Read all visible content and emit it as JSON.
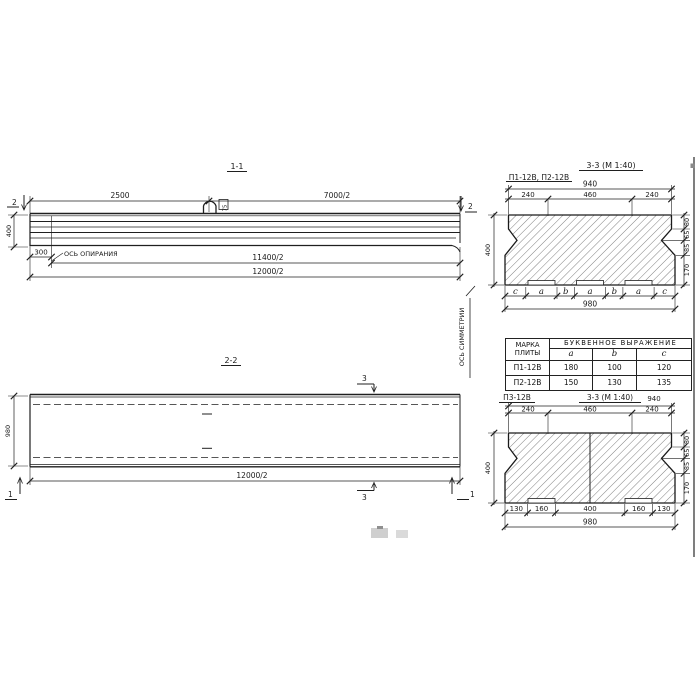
{
  "section11": {
    "title": "1-1",
    "dims": {
      "top_left": "2500",
      "top_right": "7000/2",
      "height": "400",
      "support_offset": "300",
      "to_axis": "11400/2",
      "total": "12000/2"
    },
    "support_axis_label": "ОСЬ ОПИРАНИЯ",
    "loop_label": "75",
    "cut_mark_left": "2",
    "cut_mark_right": "2"
  },
  "section22": {
    "title": "2-2",
    "dims": {
      "width": "980",
      "total": "12000/2"
    },
    "symmetry_axis_label": "ОСЬ СИММЕТРИИ",
    "cut_mark_3_top": "3",
    "cut_mark_3_bottom": "3",
    "cut_mark_1_left": "1",
    "cut_mark_1_right": "1"
  },
  "section33_top": {
    "subtitle": "П1-12В, П2-12В",
    "title": "3-3 (М 1:40)",
    "dims": {
      "top_total": "940",
      "top_left": "240",
      "top_mid": "460",
      "top_right": "240",
      "bottom_total": "980",
      "height": "400"
    },
    "right_dims": [
      "80",
      "65",
      "85",
      "170"
    ],
    "letters": [
      "c",
      "a",
      "b",
      "a",
      "b",
      "a",
      "c"
    ]
  },
  "table": {
    "col1_line1": "МАРКА",
    "col1_line2": "ПЛИТЫ",
    "group_header": "БУКВЕННОЕ ВЫРАЖЕНИЕ",
    "cols": [
      "a",
      "b",
      "c"
    ],
    "rows": [
      {
        "mark": "П1-12В",
        "a": "180",
        "b": "100",
        "c": "120"
      },
      {
        "mark": "П2-12В",
        "a": "150",
        "b": "130",
        "c": "135"
      }
    ]
  },
  "section33_bottom": {
    "label": "П3-12В",
    "title": "3-3 (М 1:40)",
    "dims": {
      "top_total": "940",
      "top_left": "240",
      "top_mid": "460",
      "top_right": "240",
      "bottom_total": "980",
      "height": "400"
    },
    "bottom_dims": [
      "130",
      "160",
      "400",
      "160",
      "130"
    ],
    "right_dims": [
      "80",
      "65",
      "85",
      "170"
    ]
  }
}
